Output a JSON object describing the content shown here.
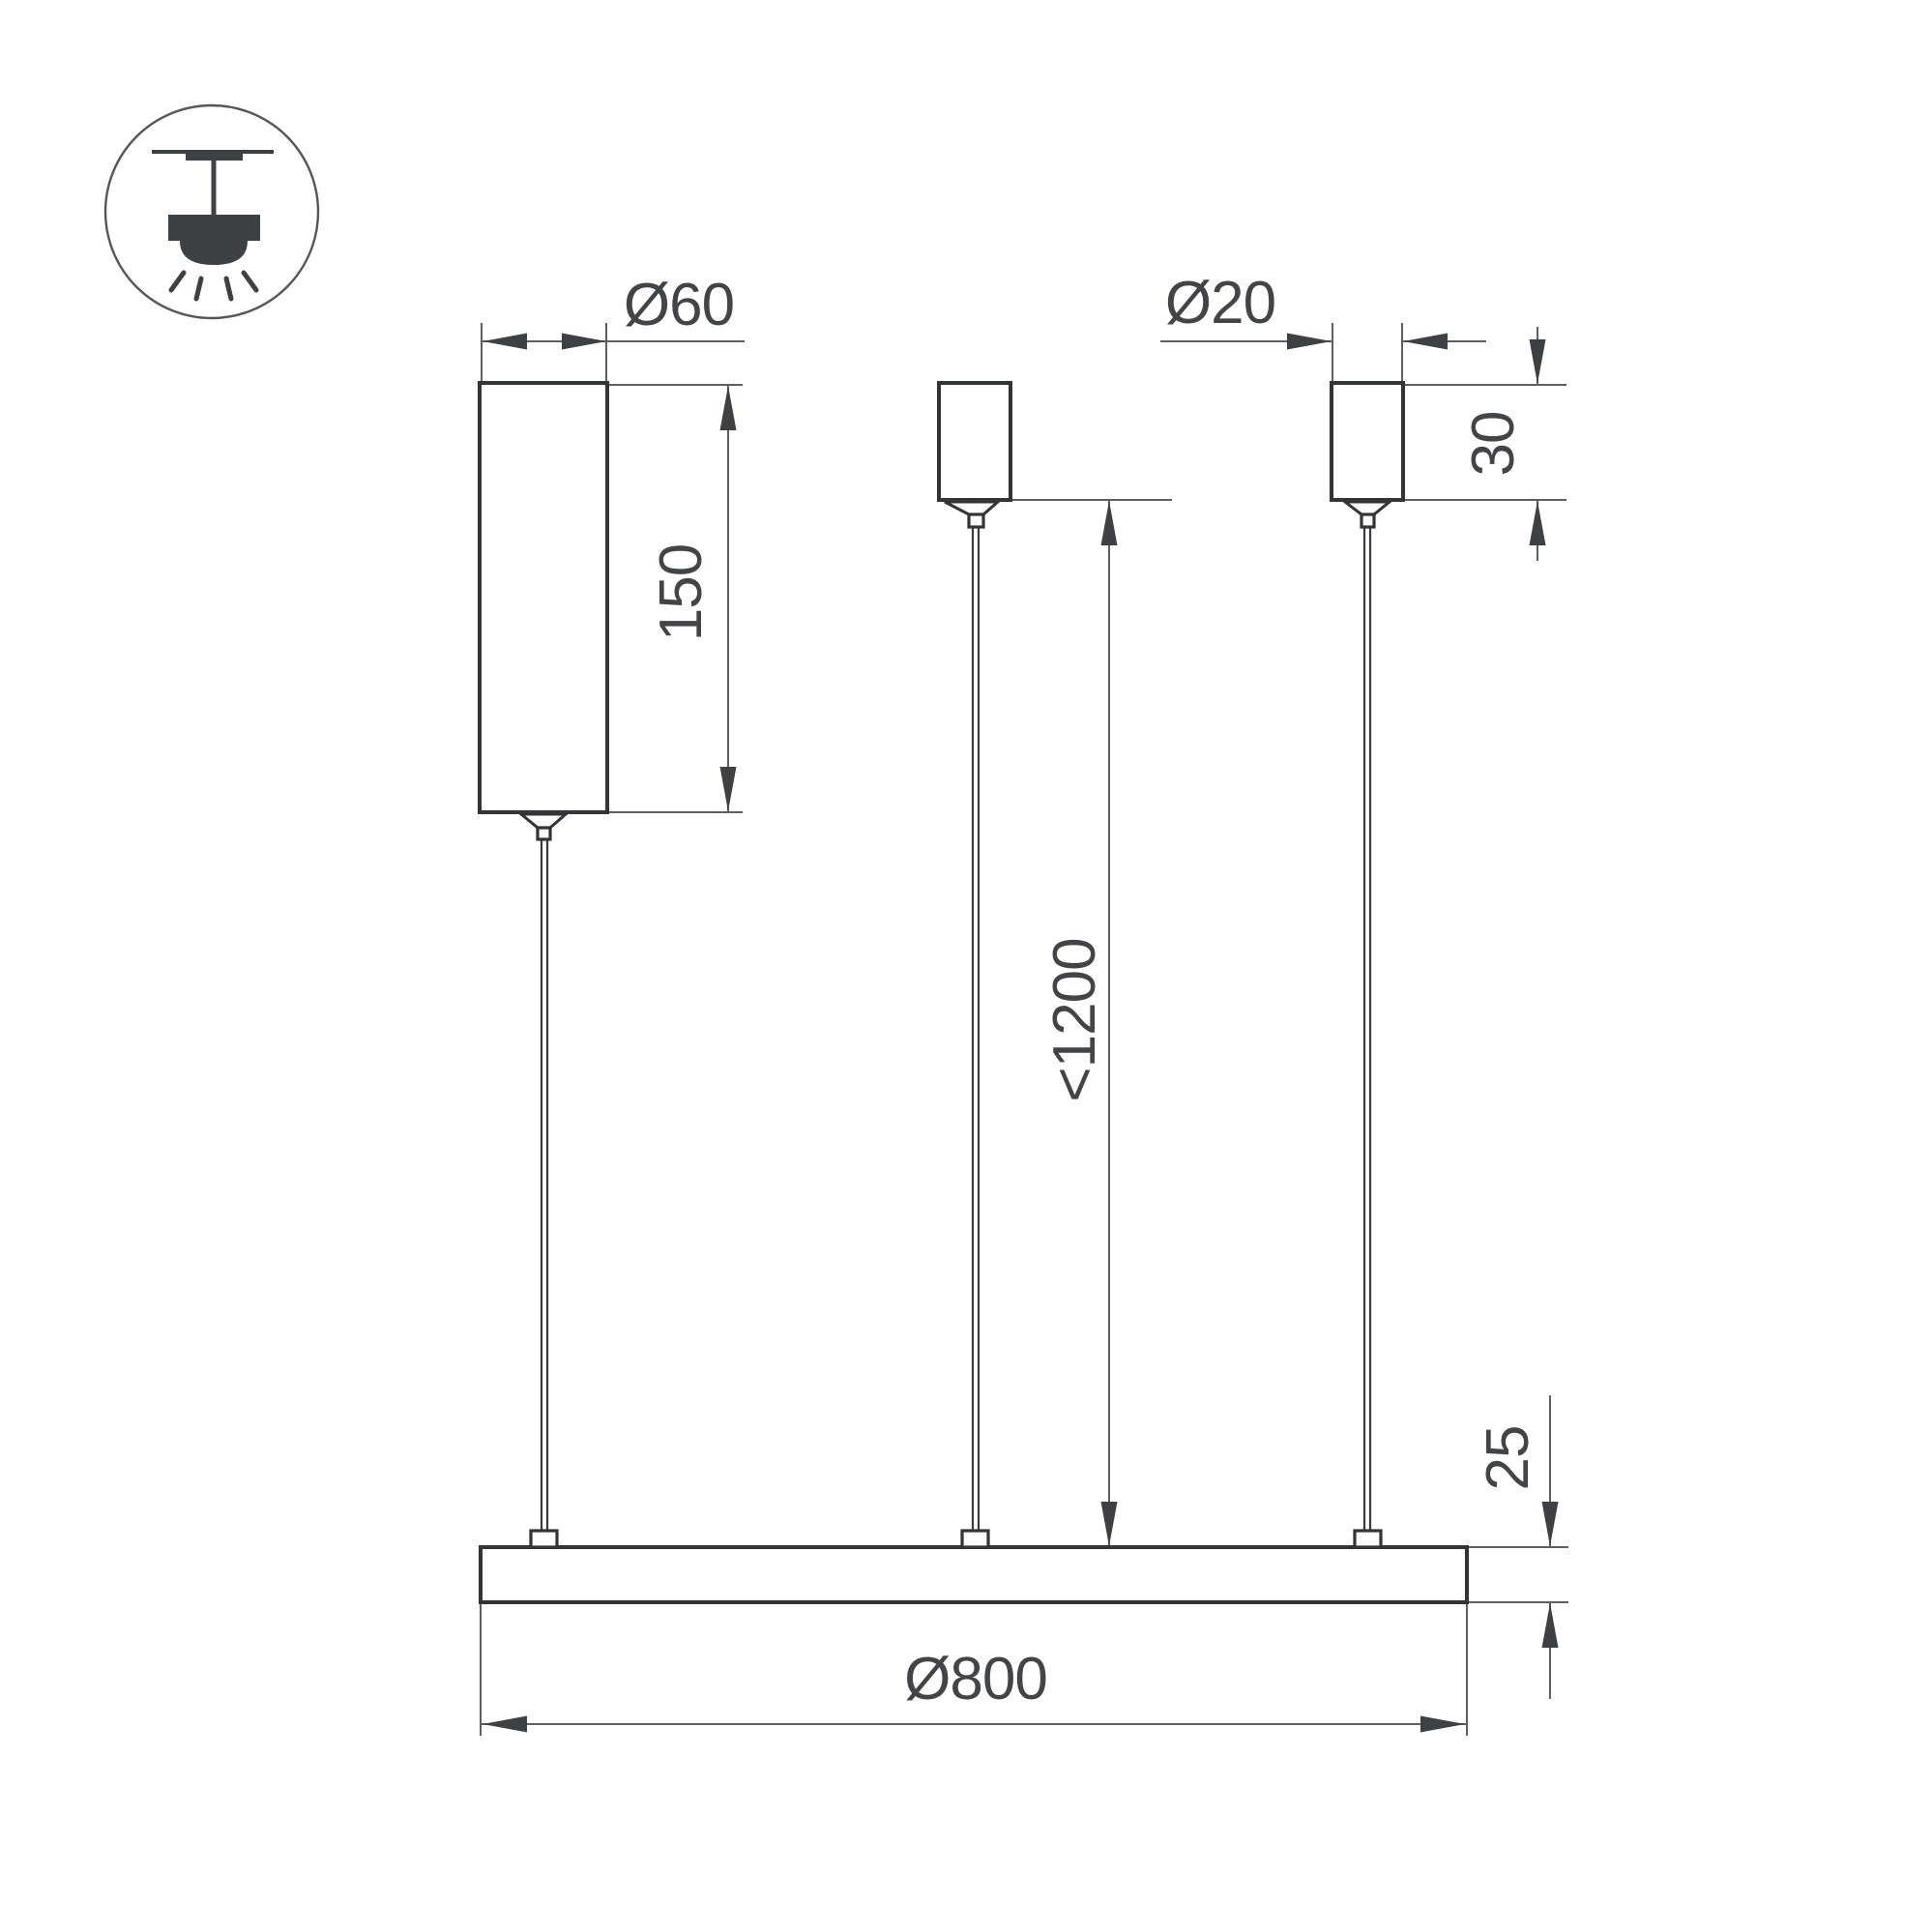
{
  "diagram": {
    "title": "pendant-luminaire-dimension-drawing",
    "mount_type_icon": "pendant-ceiling-mount",
    "dimensions": {
      "canopy_width": "Ø60",
      "canopy_height": "150",
      "holder_width": "Ø20",
      "holder_height": "30",
      "suspension_max": "<1200",
      "profile_height": "25",
      "ring_diameter": "Ø800"
    },
    "colors": {
      "outline": "#333437",
      "thin_line": "#5e5f63",
      "arrow": "#3f4043",
      "text": "#434448",
      "background": "#ffffff"
    }
  }
}
